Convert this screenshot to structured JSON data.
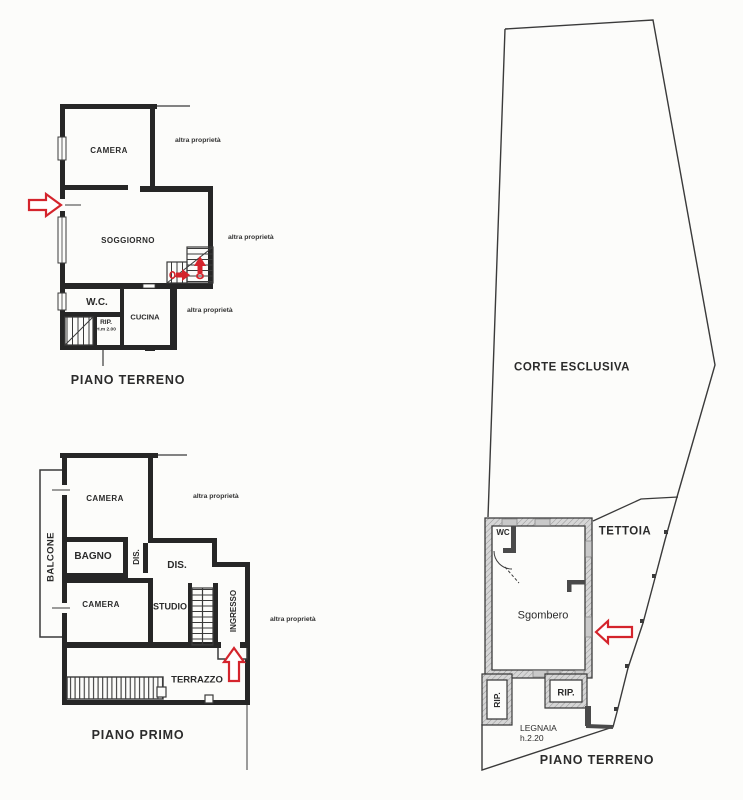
{
  "document_type": "floor-plan-scan",
  "colors": {
    "ink": "#3a3a3a",
    "wall_black": "#262626",
    "wall_gray": "#d6d6d6",
    "arrow_red": "#d4242c",
    "paper": "#fcfcfa"
  },
  "shared": {
    "neighbor_label": "altra proprietà"
  },
  "ground_floor_left": {
    "title": "PIANO TERRENO",
    "rooms": {
      "camera": "CAMERA",
      "soggiorno": "SOGGIORNO",
      "wc": "W.C.",
      "cucina": "CUCINA",
      "rip": "RIP."
    },
    "rip_height": "H.m 2.00"
  },
  "first_floor_left": {
    "title": "PIANO PRIMO",
    "rooms": {
      "camera_top": "CAMERA",
      "bagno": "BAGNO",
      "dis_corridor": "DIS.",
      "dis_hall": "DIS.",
      "camera_bottom": "CAMERA",
      "studio": "STUDIO",
      "ingresso": "INGRESSO",
      "balcone": "BALCONE",
      "terrazzo": "TERRAZZO"
    }
  },
  "ground_floor_right": {
    "title": "PIANO TERRENO",
    "court": "CORTE ESCLUSIVA",
    "canopy": "TETTOIA",
    "rooms": {
      "wc": "WC",
      "sgombero": "Sgombero",
      "rip_left": "RIP.",
      "rip_right": "RIP."
    },
    "legnaia": {
      "name": "LEGNAIA",
      "height": "h.2.20"
    }
  }
}
